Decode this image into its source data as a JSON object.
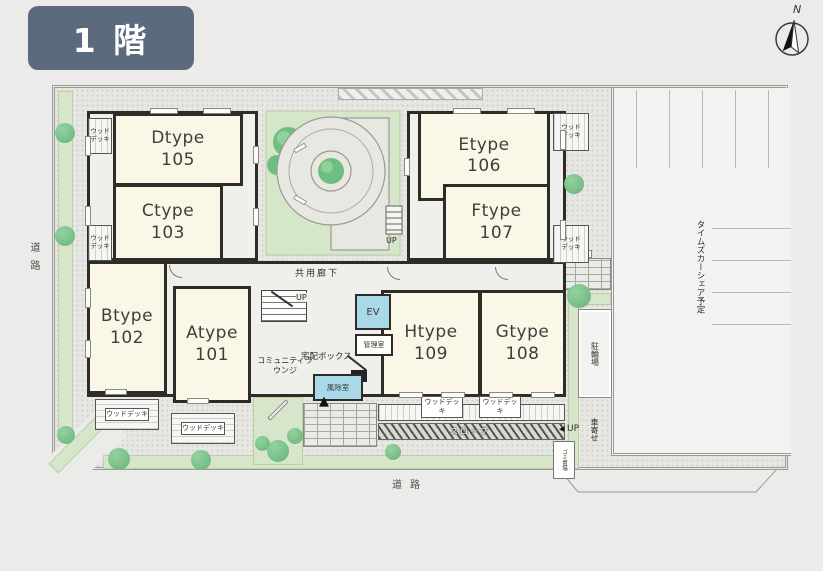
{
  "floor_badge": {
    "label": "1 階"
  },
  "compass": {
    "north": "N"
  },
  "units": {
    "a": {
      "type": "Atype",
      "number": "101"
    },
    "b": {
      "type": "Btype",
      "number": "102"
    },
    "c": {
      "type": "Ctype",
      "number": "103"
    },
    "d": {
      "type": "Dtype",
      "number": "105"
    },
    "e": {
      "type": "Etype",
      "number": "106"
    },
    "f": {
      "type": "Ftype",
      "number": "107"
    },
    "g": {
      "type": "Gtype",
      "number": "108"
    },
    "h": {
      "type": "Htype",
      "number": "109"
    }
  },
  "labels": {
    "wood_deck": "ウッドデッキ",
    "common_corridor": "共用廊下",
    "elevator": "EV",
    "manager_room": "管理室",
    "delivery_box": "宅配ボックス",
    "community_lounge": "コミュニティラウンジ",
    "windbreak_room": "風除室",
    "up": "UP",
    "slope": "スロープ",
    "bicycle_parking": "駐輪場",
    "car_porch": "車寄せ",
    "garbage_area": "ゴミ置場",
    "carshare_planned": "タイムズカーシェア予定",
    "road": "道路"
  },
  "icons": {
    "entrance_arrow": "▲",
    "up_arrow": "◀"
  },
  "colors": {
    "floor_badge": "#5B6B7D",
    "room_fill": "#FAF7E7",
    "courtyard_green": "#D5E6C9",
    "tree_green": "#6FBE80",
    "facility_blue": "#A9D8E8",
    "wall": "#2E2C29"
  }
}
